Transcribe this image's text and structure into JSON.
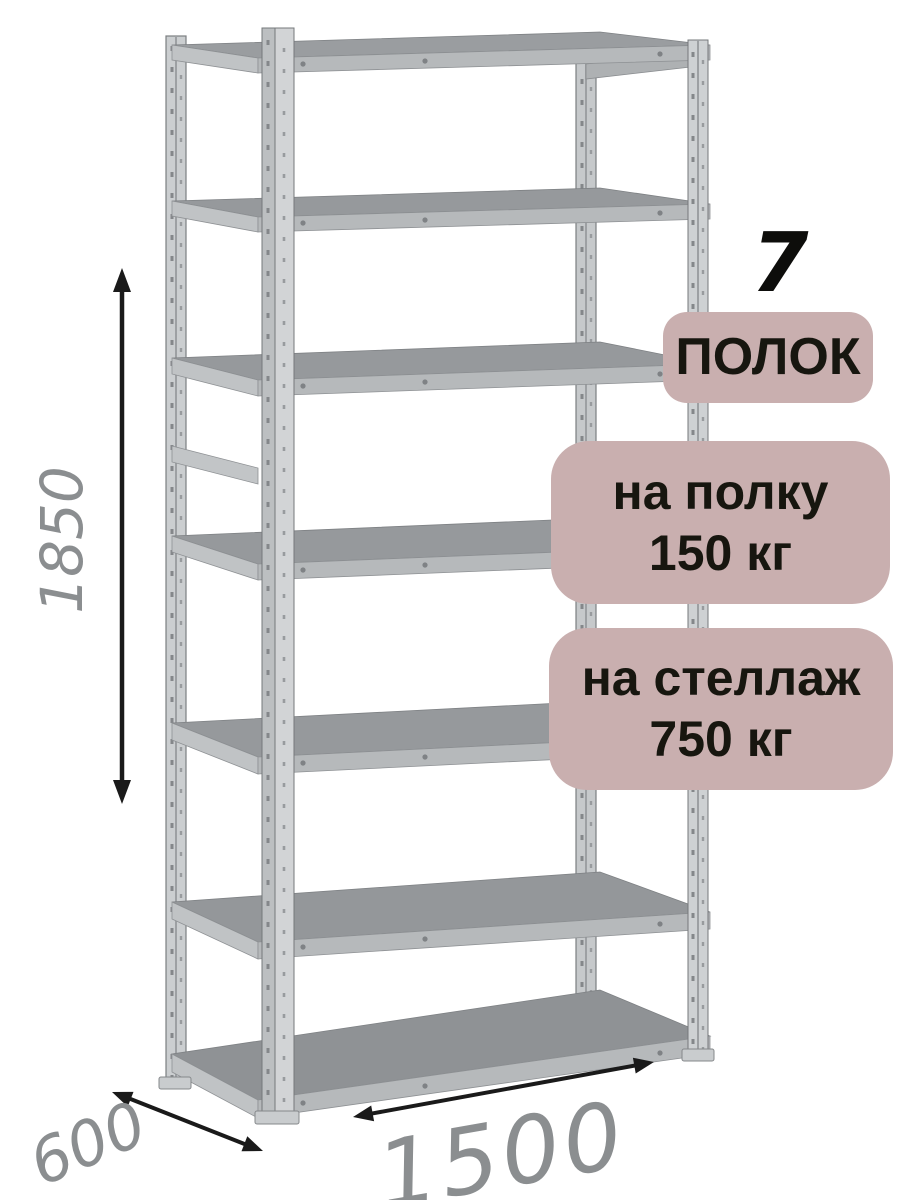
{
  "image_type": "product-render with dimension callouts",
  "subject": "metal boltless shelving rack with 7 shelves",
  "callouts": {
    "shelf_count": {
      "number": "7",
      "label": "ПОЛОК"
    },
    "per_shelf_capacity": {
      "line1": "на полку",
      "line2": "150 кг"
    },
    "total_capacity": {
      "line1": "на стеллаж",
      "line2": "750 кг"
    }
  },
  "dimensions": {
    "height": "1850",
    "depth": "600",
    "width": "1500"
  },
  "colors": {
    "background": "#ffffff",
    "badge_background": "#c9afaf",
    "badge_text": "#17160f",
    "dimension_text": "#8b8e90",
    "arrow": "#1a1a1a",
    "shelf_surface": "#96999c",
    "shelf_front_edge": "#b6b9bb",
    "post_light": "#ced1d3",
    "post_edge": "#75787b"
  }
}
